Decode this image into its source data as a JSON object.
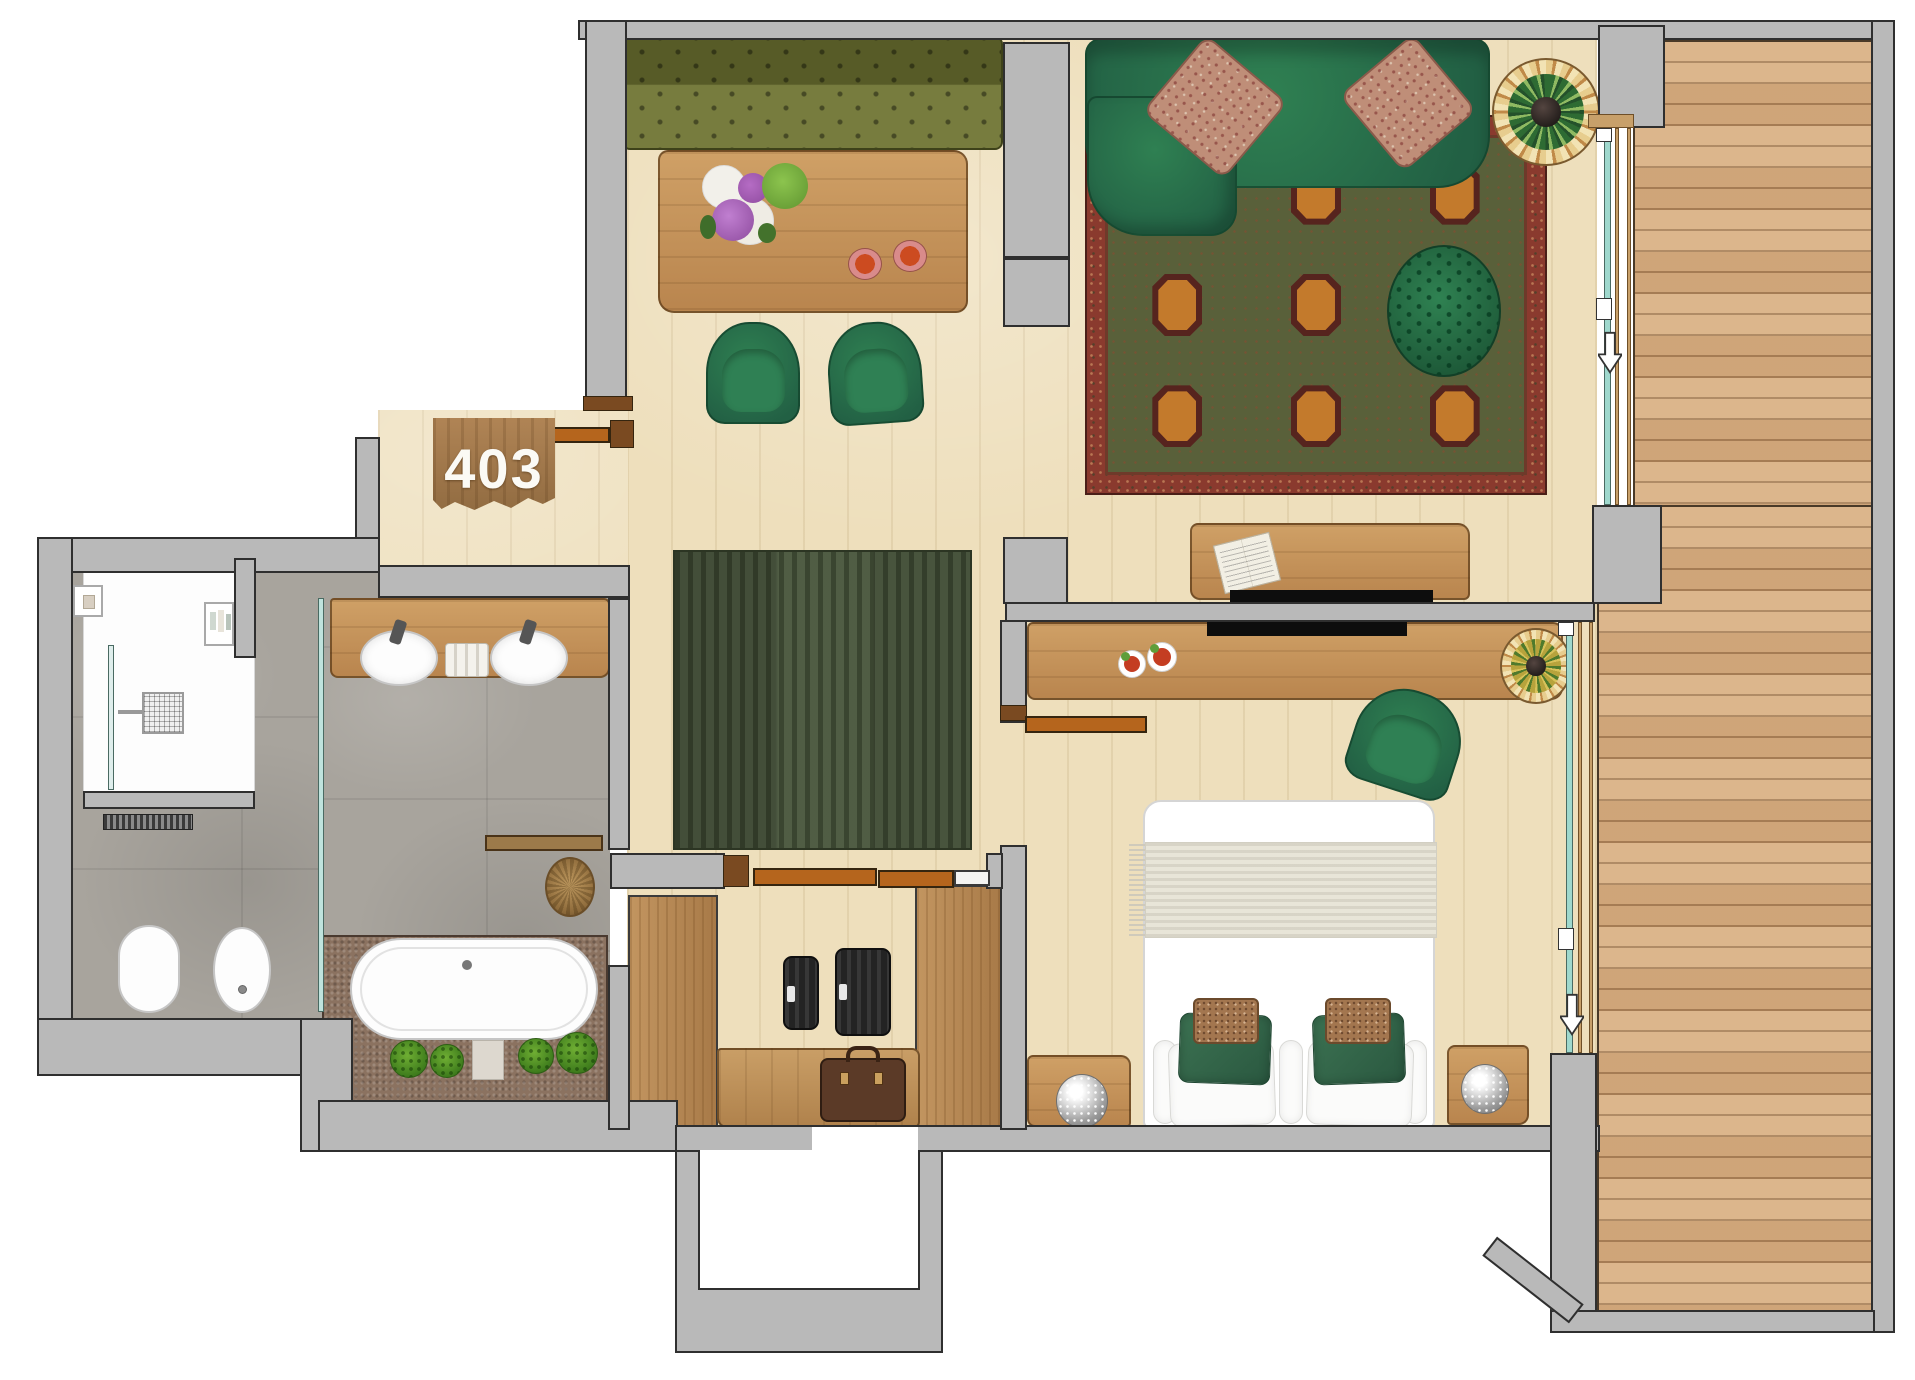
{
  "floor_plan": {
    "room_number": "403",
    "rooms": [
      "living-room",
      "dining-area",
      "bedroom",
      "bathroom",
      "shower",
      "wc-area",
      "hallway",
      "walk-in-closet",
      "entry",
      "balcony-deck"
    ],
    "furniture": {
      "dining": [
        "olive-tufted-bench",
        "dining-table",
        "flower-bouquet",
        "two-drinks",
        "green-armchair",
        "green-armchair"
      ],
      "living": [
        "green-sofa",
        "paisley-pillow",
        "paisley-pillow",
        "oriental-rug",
        "round-tufted-ottoman",
        "tiffany-floor-lamp",
        "desk-with-open-book",
        "wall-mounted-tv"
      ],
      "bedroom": [
        "double-bed",
        "throw-blanket",
        "green-pillow",
        "green-pillow",
        "patterned-pillow",
        "patterned-pillow",
        "nightstand-with-sparkle-lamp",
        "nightstand-with-sparkle-lamp",
        "long-desk",
        "green-desk-chair",
        "tiffany-table-lamp",
        "plate-of-food",
        "plate-of-food",
        "wall-mounted-tv"
      ],
      "bathroom": [
        "vanity-with-two-sinks",
        "towels",
        "rain-shower-head",
        "shower-glass",
        "wall-niche-with-toiletries",
        "towel-radiator",
        "toilet",
        "bidet",
        "freestanding-bathtub",
        "bath-mat",
        "plant",
        "plant",
        "plant",
        "plant",
        "wooden-door-leaf",
        "jute-basket"
      ],
      "closet": [
        "wardrobe-panel",
        "wardrobe-panel",
        "small-suitcase",
        "large-suitcase",
        "leather-briefcase",
        "wooden-bench"
      ],
      "balcony": [
        "wood-deck-planks",
        "sliding-glass-door",
        "sliding-glass-door",
        "door-swing-arrow",
        "door-swing-arrow"
      ]
    },
    "colors": {
      "wall": "#b9b9b9",
      "wall_outline": "#2f2f2f",
      "wood_floor": "#eedfbc",
      "deck_wood": "#d9b083",
      "sofa_green": "#2e7d52",
      "olive_green": "#6f7432",
      "hall_rug_green": "#47543a",
      "oriental_rug_red": "#8a3a2e",
      "oriental_rug_field": "#59603a",
      "tile_gray": "#a8a49d",
      "mosaic_brown": "#8b7260",
      "door_wood": "#b5651d",
      "glass_teal": "#9fd8cd"
    }
  }
}
